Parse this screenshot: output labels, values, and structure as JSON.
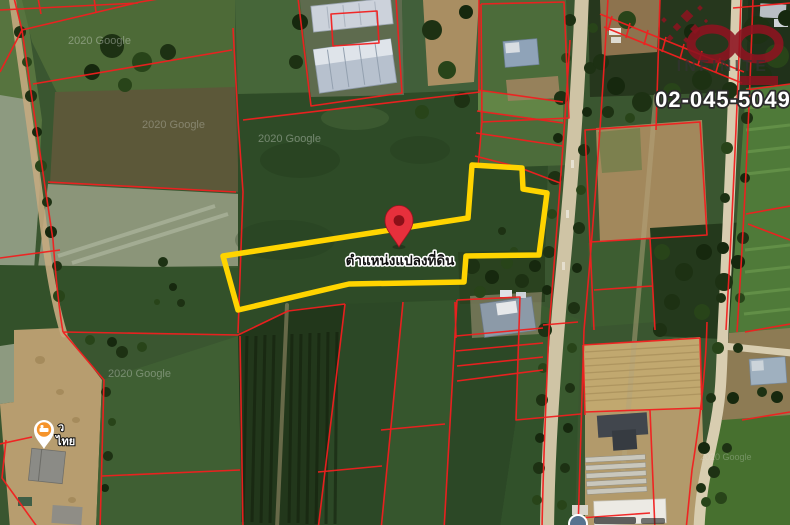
{
  "map": {
    "watermark": "2020 Google",
    "plot_label": "ตำแหน่งแปลงที่ดิน",
    "poi_label_line1": "ว",
    "poi_label_line2": "ไทย",
    "colors": {
      "parcel_line": "#f11f1f",
      "plot_outline": "#ffd400",
      "pin_red": "#e6303c",
      "pin_inner": "#8c1018",
      "brand_red": "#8e1320",
      "poi_orange": "#f5942c"
    }
  },
  "branding": {
    "logo_text": "INFINITE",
    "phone": "02-045-5049"
  }
}
